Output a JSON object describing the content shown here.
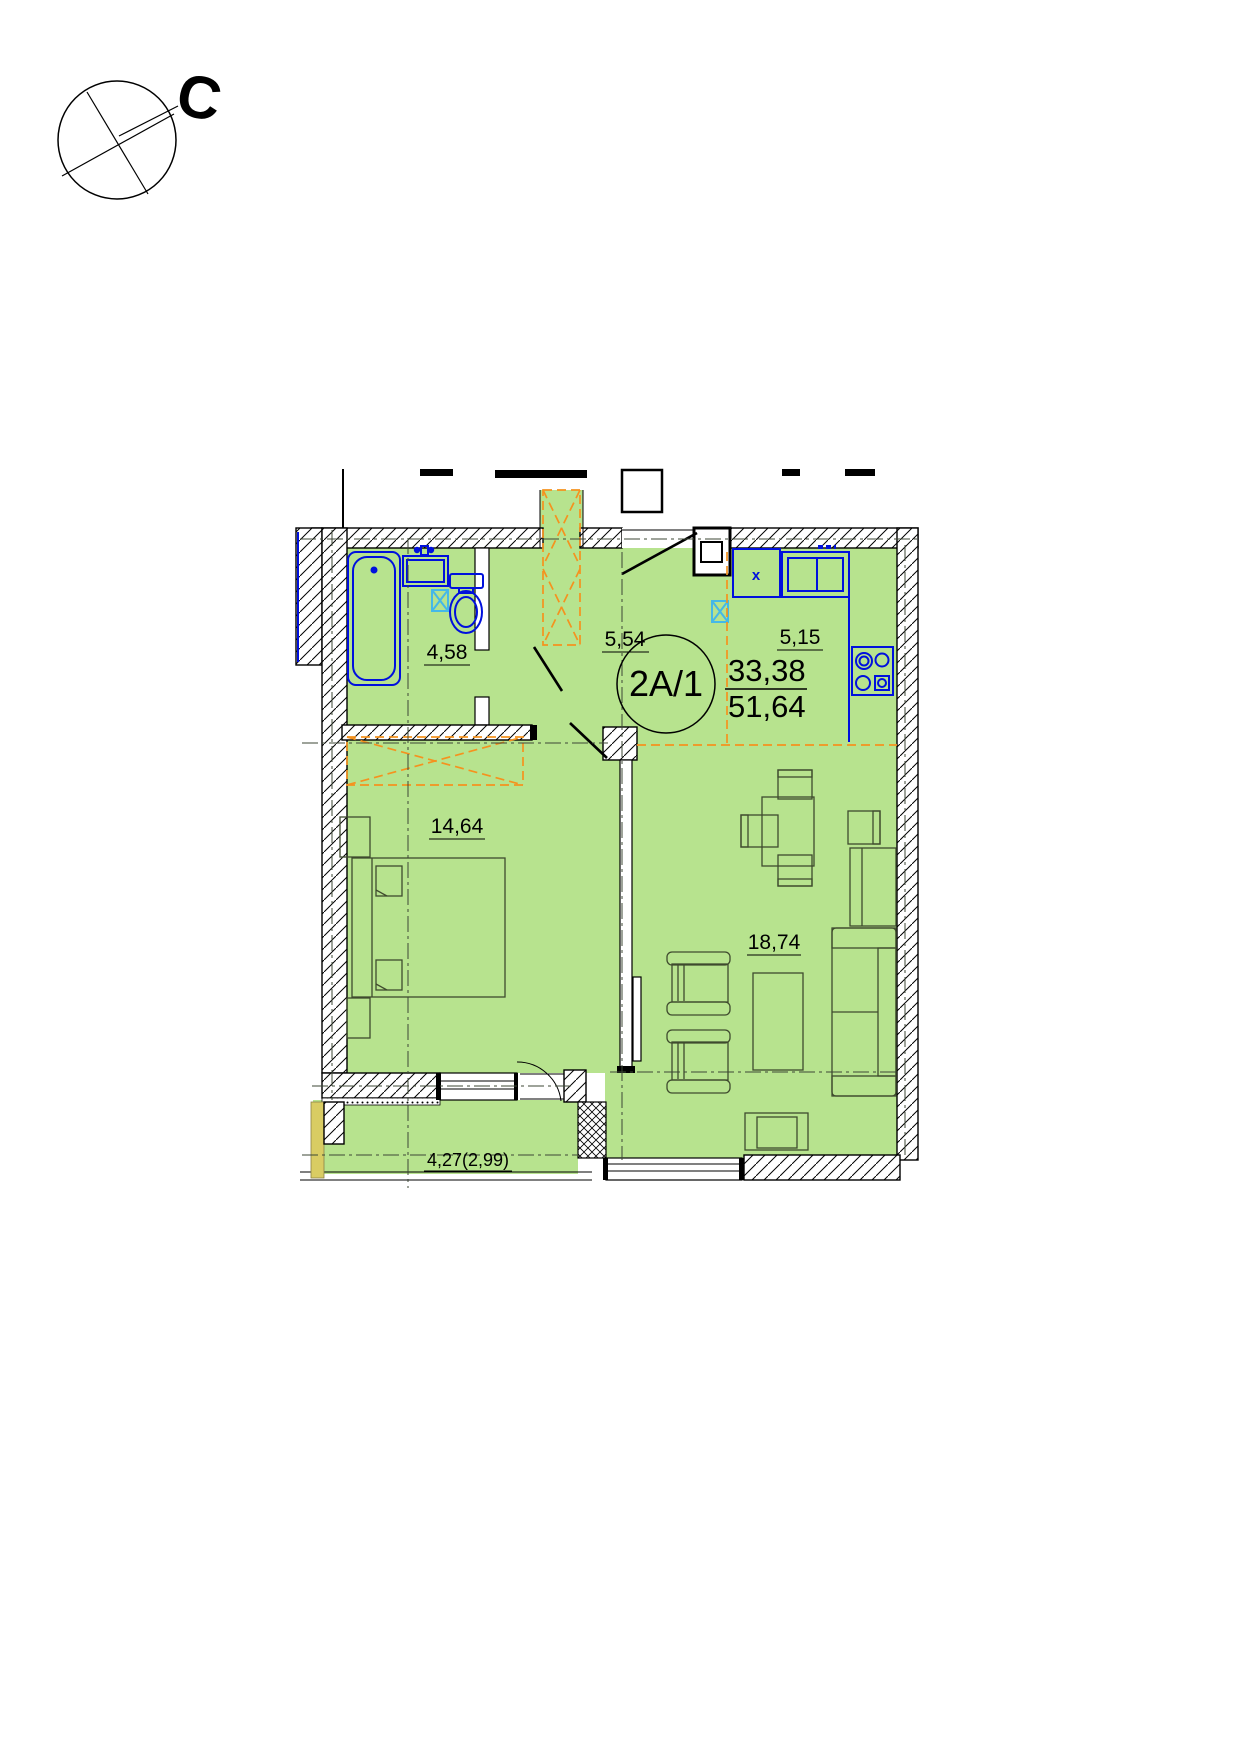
{
  "compass": {
    "north_label": "С"
  },
  "unit": {
    "code": "2А/1",
    "living_area": "33,38",
    "total_area": "51,64"
  },
  "rooms": {
    "bathroom": {
      "area": "4,58"
    },
    "hallway": {
      "area": "5,54"
    },
    "kitchen": {
      "area": "5,15"
    },
    "bedroom": {
      "area": "14,64"
    },
    "living_room": {
      "area": "18,74"
    },
    "balcony": {
      "area": "4,27(2,99)"
    }
  },
  "markers": {
    "kitchen_sink": "x"
  },
  "colors": {
    "room_fill": "#b7e38e",
    "fixture_blue": "#0010dd",
    "vent_cyan": "#45b8e8",
    "wardrobe_orange": "#f5921e",
    "balcony_wall_yellow": "#d9cc63",
    "line_black": "#000000"
  }
}
